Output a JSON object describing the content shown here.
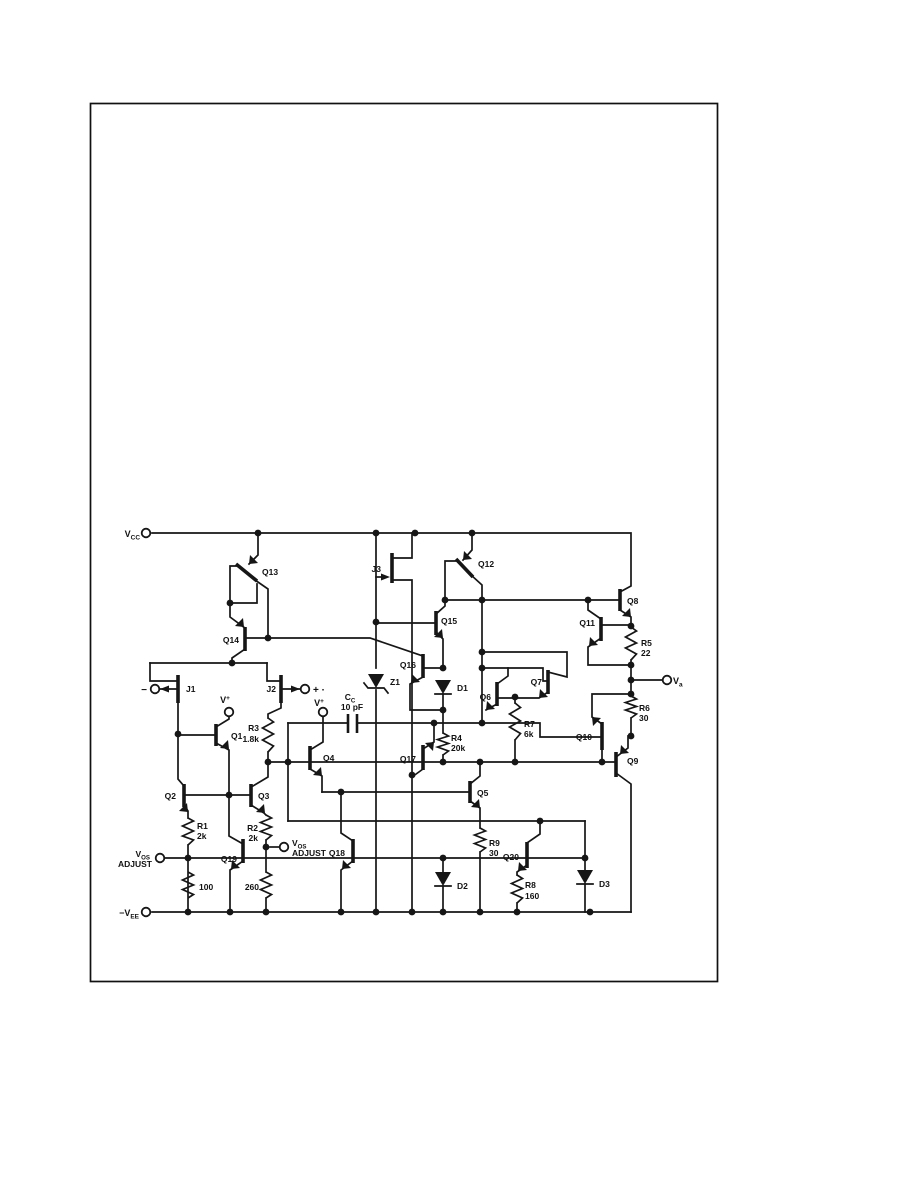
{
  "page": {
    "type": "scanned-schematic-page",
    "ink_color": "#161616",
    "paper_color": "#ffffff"
  },
  "schematic": {
    "power_rails": [
      "VCC",
      "-VEE"
    ],
    "transistors": [
      "Q1",
      "Q2",
      "Q3",
      "Q4",
      "Q5",
      "Q6",
      "Q7",
      "Q8",
      "Q9",
      "Q10",
      "Q11",
      "Q12",
      "Q13",
      "Q14",
      "Q15",
      "Q16",
      "Q17",
      "Q18",
      "Q19",
      "Q20"
    ],
    "jfets": [
      "J1",
      "J2",
      "J3"
    ],
    "resistors": [
      {
        "ref": "R1",
        "value": "2k"
      },
      {
        "ref": "R2",
        "value": "2k"
      },
      {
        "ref": "R3",
        "value": "1.8k"
      },
      {
        "ref": "R4",
        "value": "20k"
      },
      {
        "ref": "R5",
        "value": "22"
      },
      {
        "ref": "R6",
        "value": "30"
      },
      {
        "ref": "R7",
        "value": "6k"
      },
      {
        "ref": "R8",
        "value": "160"
      },
      {
        "ref": "R9",
        "value": "30"
      },
      {
        "ref": "",
        "value": "100"
      },
      {
        "ref": "",
        "value": "100"
      }
    ],
    "capacitors": [
      {
        "ref": "Cc",
        "value": "10 pF"
      }
    ],
    "diodes": [
      "D1",
      "D2",
      "D3"
    ],
    "zeners": [
      "Z1"
    ],
    "terminals": [
      "VCC",
      "-VEE",
      "V+",
      "V+",
      "VOS ADJUST",
      "VOS ADJUST",
      "-",
      "+ ·",
      "Va"
    ]
  },
  "labels": [
    {
      "id": "vcc",
      "t": "V",
      "sub": "CC",
      "x": 140,
      "y": 537,
      "a": "end",
      "s": 9
    },
    {
      "id": "q13",
      "t": "Q13",
      "x": 262,
      "y": 575,
      "a": "start",
      "s": 8.5
    },
    {
      "id": "j3",
      "t": "J3",
      "x": 381,
      "y": 572,
      "a": "end",
      "s": 8.5
    },
    {
      "id": "q12",
      "t": "Q12",
      "x": 478,
      "y": 567,
      "a": "start",
      "s": 8.5
    },
    {
      "id": "q8",
      "t": "Q8",
      "x": 627,
      "y": 604,
      "a": "start",
      "s": 8.5
    },
    {
      "id": "q14",
      "t": "Q14",
      "x": 239,
      "y": 643,
      "a": "end",
      "s": 8.5
    },
    {
      "id": "q15",
      "t": "Q15",
      "x": 441,
      "y": 624,
      "a": "start",
      "s": 8.5
    },
    {
      "id": "q11",
      "t": "Q11",
      "x": 595,
      "y": 626,
      "a": "end",
      "s": 8.5
    },
    {
      "id": "r5",
      "t": "R5",
      "x": 641,
      "y": 646,
      "a": "start",
      "s": 8.5
    },
    {
      "id": "r5v",
      "t": "22",
      "x": 641,
      "y": 656,
      "a": "start",
      "s": 8.5
    },
    {
      "id": "q16",
      "t": "Q16",
      "x": 416,
      "y": 668,
      "a": "end",
      "s": 8.5
    },
    {
      "id": "z1",
      "t": "Z1",
      "x": 390,
      "y": 685,
      "a": "start",
      "s": 8.5
    },
    {
      "id": "d1",
      "t": "D1",
      "x": 457,
      "y": 691,
      "a": "start",
      "s": 8.5
    },
    {
      "id": "q6",
      "t": "Q6",
      "x": 491,
      "y": 700,
      "a": "end",
      "s": 8.5
    },
    {
      "id": "q7",
      "t": "Q7",
      "x": 542,
      "y": 685,
      "a": "end",
      "s": 8.5
    },
    {
      "id": "vo",
      "t": "V",
      "sub": "a",
      "x": 673,
      "y": 684,
      "a": "start",
      "s": 9
    },
    {
      "id": "minus",
      "t": "−",
      "x": 147,
      "y": 693,
      "a": "end",
      "s": 10
    },
    {
      "id": "plus",
      "t": "+ ·",
      "x": 313,
      "y": 693,
      "a": "start",
      "s": 10
    },
    {
      "id": "j1",
      "t": "J1",
      "x": 186,
      "y": 692,
      "a": "start",
      "s": 8.5
    },
    {
      "id": "j2",
      "t": "J2",
      "x": 276,
      "y": 692,
      "a": "end",
      "s": 8.5
    },
    {
      "id": "vp1",
      "t": "V",
      "sup": "+",
      "x": 225,
      "y": 703,
      "a": "middle",
      "s": 9
    },
    {
      "id": "vp2",
      "t": "V",
      "sup": "+",
      "x": 319,
      "y": 706,
      "a": "middle",
      "s": 9
    },
    {
      "id": "ccl",
      "t": "C",
      "sub": "C",
      "x": 350,
      "y": 700,
      "a": "middle",
      "s": 8.5
    },
    {
      "id": "ccv",
      "t": "10 pF",
      "x": 352,
      "y": 710,
      "a": "middle",
      "s": 8.5
    },
    {
      "id": "q1",
      "t": "Q1",
      "x": 231,
      "y": 739,
      "a": "start",
      "s": 8.5
    },
    {
      "id": "r3",
      "t": "R3",
      "x": 259,
      "y": 731,
      "a": "end",
      "s": 8.5
    },
    {
      "id": "r3v",
      "t": "1.8k",
      "x": 259,
      "y": 742,
      "a": "end",
      "s": 8.5
    },
    {
      "id": "r7",
      "t": "R7",
      "x": 524,
      "y": 727,
      "a": "start",
      "s": 8.5
    },
    {
      "id": "r7v",
      "t": "6k",
      "x": 524,
      "y": 737,
      "a": "start",
      "s": 8.5
    },
    {
      "id": "q10",
      "t": "Q10",
      "x": 592,
      "y": 740,
      "a": "end",
      "s": 8.5
    },
    {
      "id": "q4",
      "t": "Q4",
      "x": 323,
      "y": 761,
      "a": "start",
      "s": 8.5
    },
    {
      "id": "q17",
      "t": "Q17",
      "x": 416,
      "y": 762,
      "a": "end",
      "s": 8.5
    },
    {
      "id": "r4",
      "t": "R4",
      "x": 451,
      "y": 741,
      "a": "start",
      "s": 8.5
    },
    {
      "id": "r4v",
      "t": "20k",
      "x": 451,
      "y": 751,
      "a": "start",
      "s": 8.5
    },
    {
      "id": "q9",
      "t": "Q9",
      "x": 627,
      "y": 764,
      "a": "start",
      "s": 8.5
    },
    {
      "id": "q2",
      "t": "Q2",
      "x": 176,
      "y": 799,
      "a": "end",
      "s": 8.5
    },
    {
      "id": "q3",
      "t": "Q3",
      "x": 258,
      "y": 799,
      "a": "start",
      "s": 8.5
    },
    {
      "id": "q5",
      "t": "Q5",
      "x": 477,
      "y": 796,
      "a": "start",
      "s": 8.5
    },
    {
      "id": "r6",
      "t": "R6",
      "x": 639,
      "y": 711,
      "a": "start",
      "s": 8.5
    },
    {
      "id": "r6v",
      "t": "30",
      "x": 639,
      "y": 721,
      "a": "start",
      "s": 8.5
    },
    {
      "id": "r1",
      "t": "R1",
      "x": 197,
      "y": 829,
      "a": "start",
      "s": 8.5
    },
    {
      "id": "r1v",
      "t": "2k",
      "x": 197,
      "y": 839,
      "a": "start",
      "s": 8.5
    },
    {
      "id": "r2",
      "t": "R2",
      "x": 258,
      "y": 831,
      "a": "end",
      "s": 8.5
    },
    {
      "id": "r2v",
      "t": "2k",
      "x": 258,
      "y": 841,
      "a": "end",
      "s": 8.5
    },
    {
      "id": "vosl1",
      "t": "V",
      "sub": "OS",
      "x": 150,
      "y": 857,
      "a": "end",
      "s": 8.5
    },
    {
      "id": "vosl2",
      "t": "ADJUST",
      "x": 152,
      "y": 867,
      "a": "end",
      "s": 8.5
    },
    {
      "id": "vosr1",
      "t": "V",
      "sub": "OS",
      "x": 292,
      "y": 846,
      "a": "start",
      "s": 8.5
    },
    {
      "id": "vosr2",
      "t": "ADJUST",
      "x": 292,
      "y": 856,
      "a": "start",
      "s": 8.5
    },
    {
      "id": "q19",
      "t": "Q19",
      "x": 237,
      "y": 862,
      "a": "end",
      "s": 8.5
    },
    {
      "id": "q18",
      "t": "Q18",
      "x": 345,
      "y": 856,
      "a": "end",
      "s": 8.5
    },
    {
      "id": "q20",
      "t": "Q20",
      "x": 519,
      "y": 860,
      "a": "end",
      "s": 8.5
    },
    {
      "id": "r9",
      "t": "R9",
      "x": 489,
      "y": 846,
      "a": "start",
      "s": 8.5
    },
    {
      "id": "r9v",
      "t": "30",
      "x": 489,
      "y": 856,
      "a": "start",
      "s": 8.5
    },
    {
      "id": "d2",
      "t": "D2",
      "x": 457,
      "y": 889,
      "a": "start",
      "s": 8.5
    },
    {
      "id": "r8",
      "t": "R8",
      "x": 525,
      "y": 888,
      "a": "start",
      "s": 8.5
    },
    {
      "id": "r8v",
      "t": "160",
      "x": 525,
      "y": 899,
      "a": "start",
      "s": 8.5
    },
    {
      "id": "d3",
      "t": "D3",
      "x": 599,
      "y": 887,
      "a": "start",
      "s": 8.5
    },
    {
      "id": "h1",
      "t": "100",
      "x": 199,
      "y": 890,
      "a": "start",
      "s": 8.5
    },
    {
      "id": "h2",
      "t": "260",
      "x": 259,
      "y": 890,
      "a": "end",
      "s": 8.5
    },
    {
      "id": "vee",
      "t": "−V",
      "sub": "EE",
      "x": 139,
      "y": 916,
      "a": "end",
      "s": 9
    }
  ]
}
